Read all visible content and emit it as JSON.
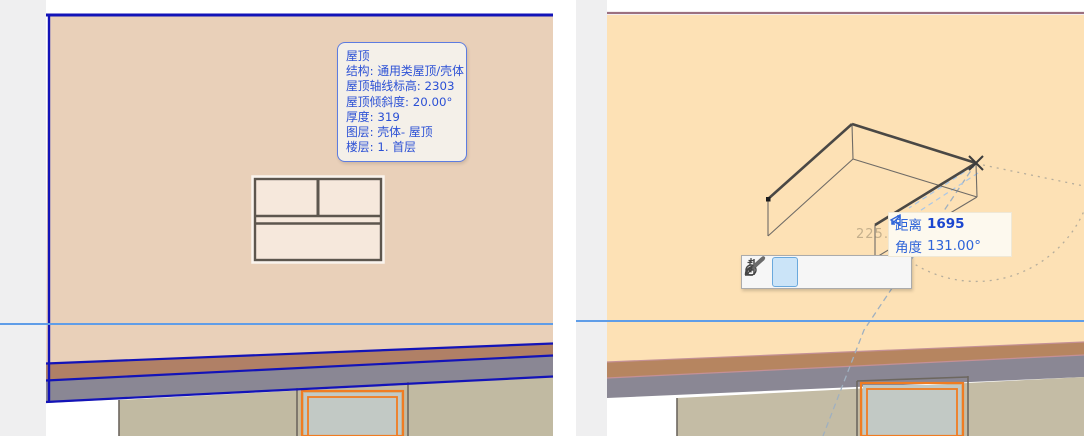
{
  "window": {
    "width": 1084,
    "height": 436,
    "app": "CAD dual viewport (elevation + 3D)"
  },
  "left_view": {
    "description": "2D elevation viewport with selected roof",
    "roof_tooltip": {
      "title": "屋顶",
      "lines": [
        "结构: 通用类屋顶/壳体",
        "屋顶轴线标高: 2303",
        "屋顶倾斜度: 20.00°",
        "厚度: 319",
        "图层: 壳体- 屋顶",
        "楼层: 1. 首层"
      ]
    }
  },
  "right_view": {
    "description": "3D viewport with roof polyline being drawn",
    "measurement": {
      "distance_label": "距离",
      "distance_value": "1695",
      "angle_label": "角度",
      "angle_value": "131.00°"
    },
    "faded_angle_text": "225.60",
    "pet_palette": {
      "tools": [
        {
          "name": "straight-segment-bar",
          "selected": false
        },
        {
          "name": "polyline-straight",
          "selected": true
        },
        {
          "name": "polyline-tangent-arc",
          "selected": false
        },
        {
          "name": "polyline-point-arc",
          "selected": false
        },
        {
          "name": "polyline-center-arc",
          "selected": false
        },
        {
          "name": "polyline-full-circle",
          "selected": false
        }
      ]
    }
  },
  "colors": {
    "selection_blue": "#1313b8",
    "guide_blue": "#5f9de8",
    "tooltip_text_blue": "#2b50d5",
    "roof_fill_left": "#e9d0b9",
    "roof_fill_right": "#fde1b5",
    "fascia_brown": "#b08066",
    "band_gray": "#8a8794",
    "wall_khaki": "#c1baa2",
    "window_orange": "#f07c22",
    "glass_gray": "#c2c9c5",
    "selected_tool_bg": "#cbe4f8"
  }
}
